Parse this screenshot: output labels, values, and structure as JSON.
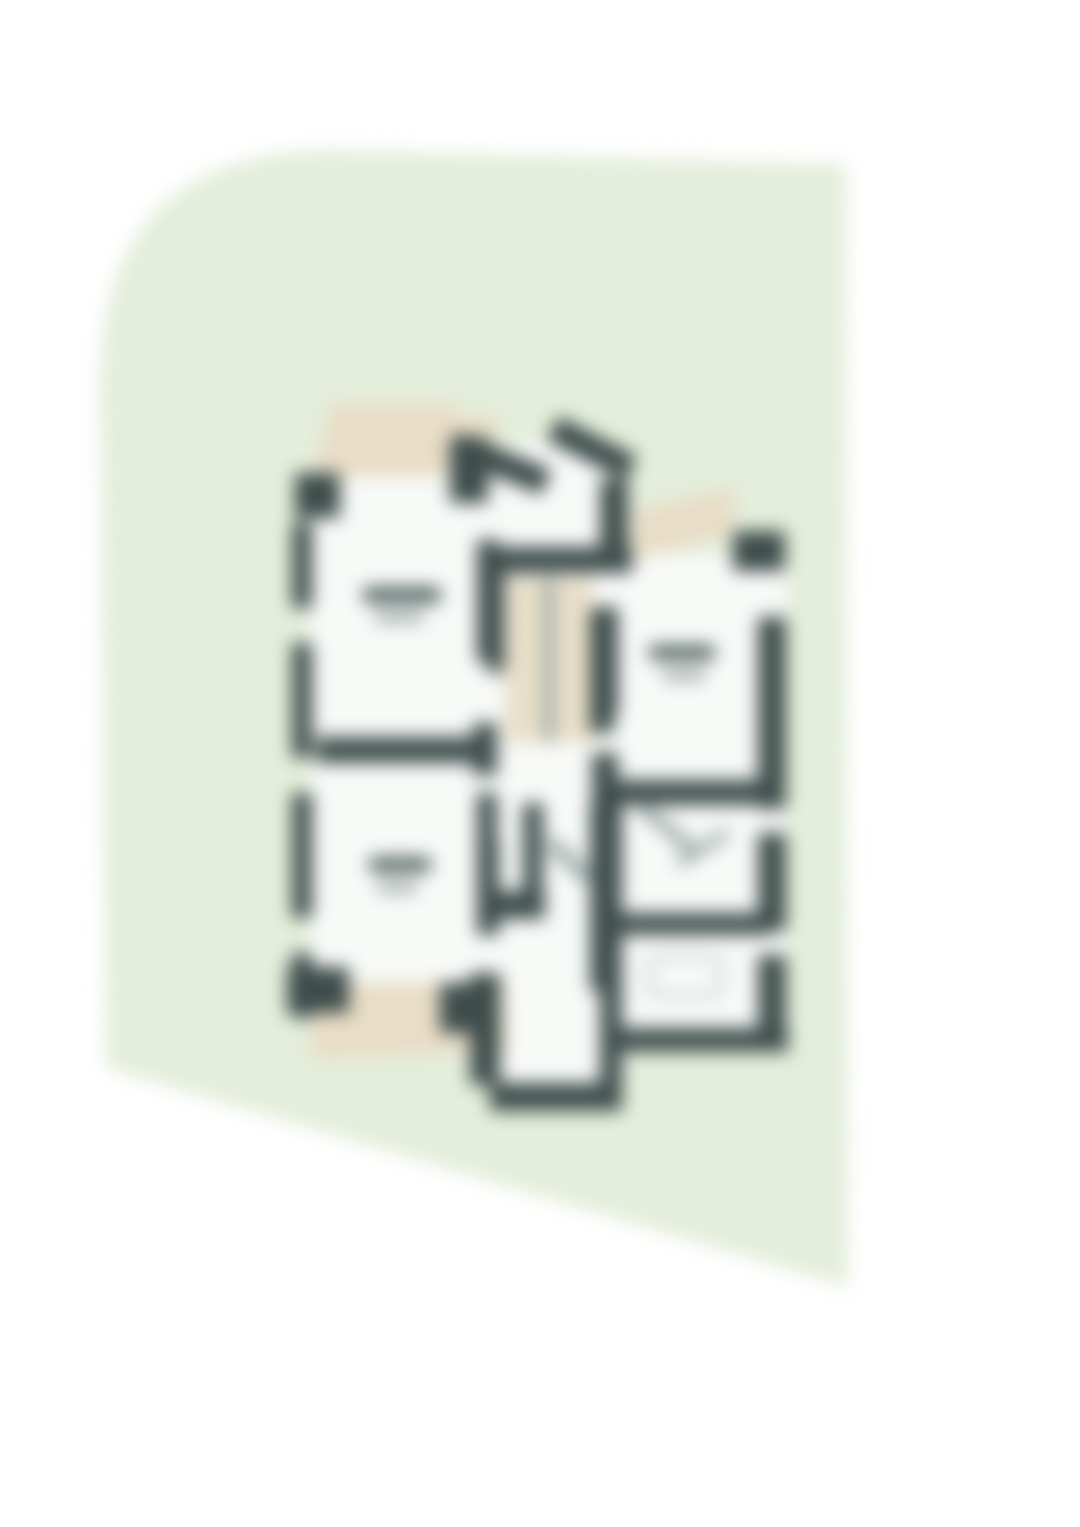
{
  "page": {
    "width": 1080,
    "height": 1527,
    "background": "#ffffff"
  },
  "card": {
    "fill": "#e4eedb",
    "path": "M 100 380 Q 103 152 330 150 L 846 164 L 848 1287 L 106 1068 Z",
    "blur_px": 9
  },
  "floorplan": {
    "origin": {
      "x": 280,
      "y": 395,
      "w": 520,
      "h": 730
    },
    "colors": {
      "wall": "#3e4d4c",
      "room": "#f8faf8",
      "terrace": "#e8ddc6",
      "stairs_light": "#efe6d2",
      "stairs_dark": "#dcd2ba",
      "divider": "#8b9795",
      "label_dark": "#4e5f5d",
      "label_light": "#8d9a98",
      "fixture_border": "#b7c1bf",
      "arc": "#9aa8a6"
    },
    "shapes": [
      {
        "name": "room-upper-left",
        "type": "room",
        "x": 30,
        "y": 75,
        "w": 170,
        "h": 267,
        "color": "room"
      },
      {
        "name": "room-lower-left",
        "type": "room",
        "x": 30,
        "y": 367,
        "w": 170,
        "h": 220,
        "color": "room"
      },
      {
        "name": "room-middle-column",
        "type": "room",
        "x": 200,
        "y": 75,
        "w": 150,
        "h": 590,
        "color": "room"
      },
      {
        "name": "room-right-unit",
        "type": "room",
        "x": 335,
        "y": 160,
        "w": 172,
        "h": 498,
        "color": "room"
      },
      {
        "name": "room-entry-notch",
        "type": "room",
        "x": 225,
        "y": 48,
        "w": 92,
        "h": 110,
        "color": "room"
      },
      {
        "name": "room-bottom-porch",
        "type": "room",
        "x": 215,
        "y": 560,
        "w": 110,
        "h": 128,
        "color": "room"
      },
      {
        "name": "terrace-top-left-a",
        "type": "terrace",
        "x": 42,
        "y": 8,
        "w": 128,
        "h": 74,
        "skewX": -14,
        "color": "terrace"
      },
      {
        "name": "terrace-top-left-b",
        "type": "terrace",
        "x": 158,
        "y": 22,
        "w": 54,
        "h": 56,
        "skewX": -14,
        "color": "terrace"
      },
      {
        "name": "terrace-right",
        "type": "terrace",
        "x": 352,
        "y": 104,
        "w": 102,
        "h": 48,
        "skewY": -14,
        "color": "terrace"
      },
      {
        "name": "terrace-bottom-left",
        "type": "terrace",
        "x": 30,
        "y": 588,
        "w": 196,
        "h": 72,
        "rot": -2,
        "color": "terrace"
      },
      {
        "name": "staircase",
        "type": "stairs",
        "x": 225,
        "y": 183,
        "w": 88,
        "h": 164
      },
      {
        "name": "stair-center-divider",
        "type": "stair-divider",
        "x": 265,
        "y": 183,
        "w": 8,
        "h": 164,
        "color": "divider"
      },
      {
        "name": "wall-corner-top-left",
        "type": "wall",
        "x": 15,
        "y": 78,
        "w": 45,
        "h": 45,
        "color": "wall"
      },
      {
        "name": "wall-left-seg-1",
        "type": "wall",
        "x": 12,
        "y": 128,
        "w": 20,
        "h": 85,
        "color": "wall"
      },
      {
        "name": "wall-left-seg-2",
        "type": "wall",
        "x": 12,
        "y": 248,
        "w": 20,
        "h": 115,
        "color": "wall"
      },
      {
        "name": "wall-left-seg-3",
        "type": "wall",
        "x": 12,
        "y": 398,
        "w": 20,
        "h": 125,
        "color": "wall"
      },
      {
        "name": "wall-left-seg-4",
        "type": "wall",
        "x": 12,
        "y": 558,
        "w": 20,
        "h": 65,
        "color": "wall"
      },
      {
        "name": "wall-corner-bottom-left",
        "type": "wall",
        "x": 7,
        "y": 572,
        "w": 62,
        "h": 46,
        "color": "wall"
      },
      {
        "name": "wall-left-unit-top-right",
        "type": "wall",
        "x": 170,
        "y": 42,
        "w": 38,
        "h": 66,
        "color": "wall"
      },
      {
        "name": "wall-left-unit-right-1",
        "type": "wall",
        "x": 197,
        "y": 145,
        "w": 22,
        "h": 122,
        "color": "wall"
      },
      {
        "name": "wall-left-unit-right-2",
        "type": "wall",
        "x": 193,
        "y": 328,
        "w": 24,
        "h": 52,
        "color": "wall"
      },
      {
        "name": "wall-mid-horizontal",
        "type": "wall",
        "x": 37,
        "y": 342,
        "w": 162,
        "h": 26,
        "color": "wall"
      },
      {
        "name": "wall-left-unit-right-3",
        "type": "wall",
        "x": 197,
        "y": 445,
        "w": 22,
        "h": 95,
        "color": "wall"
      },
      {
        "name": "wall-bottom-junction",
        "type": "wall",
        "x": 160,
        "y": 588,
        "w": 60,
        "h": 50,
        "color": "wall"
      },
      {
        "name": "wall-entry-wedge-left",
        "type": "wall",
        "x": 170,
        "y": 55,
        "w": 100,
        "h": 27,
        "rot": 22,
        "color": "wall"
      },
      {
        "name": "wall-entry-wedge-right",
        "type": "wall",
        "x": 268,
        "y": 40,
        "w": 88,
        "h": 27,
        "rot": 27,
        "color": "wall"
      },
      {
        "name": "wall-right-unit-top-left",
        "type": "wall",
        "x": 320,
        "y": 84,
        "w": 28,
        "h": 82,
        "color": "wall"
      },
      {
        "name": "wall-below-entry",
        "type": "wall",
        "x": 210,
        "y": 152,
        "w": 142,
        "h": 26,
        "color": "wall"
      },
      {
        "name": "wall-stair-left",
        "type": "wall",
        "x": 208,
        "y": 178,
        "w": 16,
        "h": 100,
        "color": "wall"
      },
      {
        "name": "wall-stair-right",
        "type": "wall",
        "x": 310,
        "y": 216,
        "w": 24,
        "h": 122,
        "color": "wall"
      },
      {
        "name": "wall-right-unit-top-right",
        "type": "wall",
        "x": 453,
        "y": 136,
        "w": 52,
        "h": 40,
        "color": "wall"
      },
      {
        "name": "wall-right-seg-1",
        "type": "wall",
        "x": 478,
        "y": 222,
        "w": 28,
        "h": 192,
        "color": "wall"
      },
      {
        "name": "wall-right-seg-2",
        "type": "wall",
        "x": 478,
        "y": 438,
        "w": 28,
        "h": 98,
        "color": "wall"
      },
      {
        "name": "wall-right-seg-3",
        "type": "wall",
        "x": 478,
        "y": 560,
        "w": 28,
        "h": 80,
        "color": "wall"
      },
      {
        "name": "wall-right-unit-left-2",
        "type": "wall",
        "x": 312,
        "y": 212,
        "w": 26,
        "h": 108,
        "color": "wall"
      },
      {
        "name": "wall-right-unit-left-3",
        "type": "wall",
        "x": 312,
        "y": 358,
        "w": 26,
        "h": 60,
        "color": "wall"
      },
      {
        "name": "wall-right-horizontal-1",
        "type": "wall",
        "x": 330,
        "y": 385,
        "w": 162,
        "h": 25,
        "color": "wall"
      },
      {
        "name": "wall-right-horizontal-2",
        "type": "wall",
        "x": 330,
        "y": 518,
        "w": 162,
        "h": 22,
        "color": "wall"
      },
      {
        "name": "wall-right-unit-bottom",
        "type": "wall",
        "x": 340,
        "y": 633,
        "w": 168,
        "h": 24,
        "color": "wall"
      },
      {
        "name": "wall-midbottom-left",
        "type": "wall",
        "x": 197,
        "y": 398,
        "w": 20,
        "h": 130,
        "color": "wall"
      },
      {
        "name": "wall-midbottom-inner",
        "type": "wall",
        "x": 243,
        "y": 408,
        "w": 20,
        "h": 88,
        "color": "wall"
      },
      {
        "name": "wall-midbottom-connector",
        "type": "wall",
        "x": 217,
        "y": 496,
        "w": 48,
        "h": 28,
        "color": "wall"
      },
      {
        "name": "wall-midbottom-right",
        "type": "wall",
        "x": 310,
        "y": 408,
        "w": 32,
        "h": 188,
        "color": "wall"
      },
      {
        "name": "wall-bottomroom-left",
        "type": "wall",
        "x": 190,
        "y": 578,
        "w": 30,
        "h": 112,
        "color": "wall"
      },
      {
        "name": "wall-bottomroom-bottom",
        "type": "wall",
        "x": 210,
        "y": 688,
        "w": 132,
        "h": 28,
        "color": "wall"
      },
      {
        "name": "wall-bottomroom-right",
        "type": "wall",
        "x": 320,
        "y": 578,
        "w": 22,
        "h": 120,
        "color": "wall"
      },
      {
        "name": "bathtub",
        "type": "tub",
        "x": 367,
        "y": 560,
        "w": 76,
        "h": 42,
        "r": 10
      },
      {
        "name": "door-swing-mid",
        "type": "door-arc",
        "x": 262,
        "y": 458,
        "w": 54,
        "h": 14,
        "rot": 45,
        "color": "arc"
      },
      {
        "name": "door-swing-right-a",
        "type": "door-arc",
        "x": 352,
        "y": 428,
        "w": 72,
        "h": 12,
        "rot": 40,
        "color": "arc"
      },
      {
        "name": "door-swing-right-b",
        "type": "door-arc",
        "x": 392,
        "y": 448,
        "w": 62,
        "h": 10,
        "rot": -32,
        "color": "arc"
      },
      {
        "name": "label-room-upper-left-line1",
        "type": "label-line",
        "x": 82,
        "y": 192,
        "w": 80,
        "h": 16,
        "r": 8,
        "color": "label_dark"
      },
      {
        "name": "label-room-upper-left-line2",
        "type": "label-line",
        "x": 94,
        "y": 218,
        "w": 50,
        "h": 9,
        "r": 5,
        "color": "label_light"
      },
      {
        "name": "label-room-lower-left-line1",
        "type": "label-line",
        "x": 88,
        "y": 462,
        "w": 64,
        "h": 15,
        "r": 8,
        "color": "label_dark"
      },
      {
        "name": "label-room-lower-left-line2",
        "type": "label-line",
        "x": 96,
        "y": 488,
        "w": 42,
        "h": 9,
        "r": 5,
        "color": "label_light"
      },
      {
        "name": "label-room-right-line1",
        "type": "label-line",
        "x": 368,
        "y": 250,
        "w": 68,
        "h": 15,
        "r": 8,
        "color": "label_dark"
      },
      {
        "name": "label-room-right-line2",
        "type": "label-line",
        "x": 382,
        "y": 276,
        "w": 44,
        "h": 9,
        "r": 5,
        "color": "label_light"
      }
    ]
  }
}
